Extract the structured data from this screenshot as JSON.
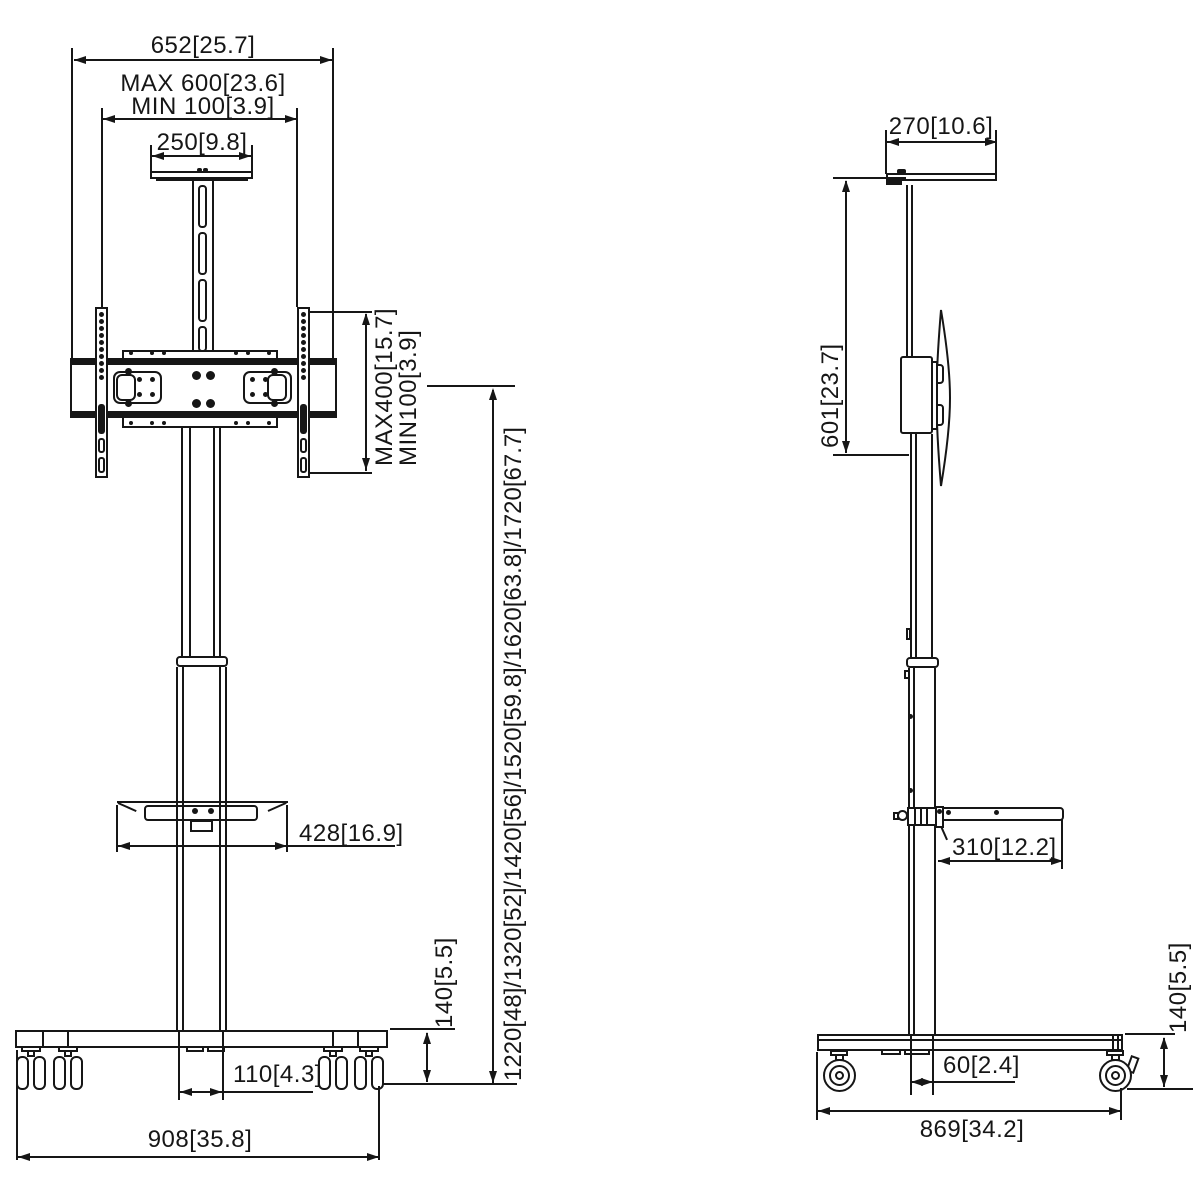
{
  "front_view": {
    "width_total": "652[25.7]",
    "vesa_width_max": "MAX 600[23.6]",
    "vesa_width_min": "MIN 100[3.9]",
    "top_shelf_width": "250[9.8]",
    "vesa_height_max": "MAX400[15.7]",
    "vesa_height_min": "MIN100[3.9]",
    "shelf_width": "428[16.9]",
    "base_height": "140[5.5]",
    "screen_heights": "1220[48]/1320[52]/1420[56]/1520[59.8]/1620[63.8]/1720[67.7]",
    "column_width": "110[4.3]",
    "base_width": "908[35.8]"
  },
  "side_view": {
    "top_shelf_depth": "270[10.6]",
    "shelf_to_screen": "601[23.7]",
    "shelf_depth": "310[12.2]",
    "column_depth": "60[2.4]",
    "base_depth": "869[34.2]",
    "base_height": "140[5.5]"
  },
  "colors": {
    "line": "#161616",
    "background": "#ffffff"
  }
}
